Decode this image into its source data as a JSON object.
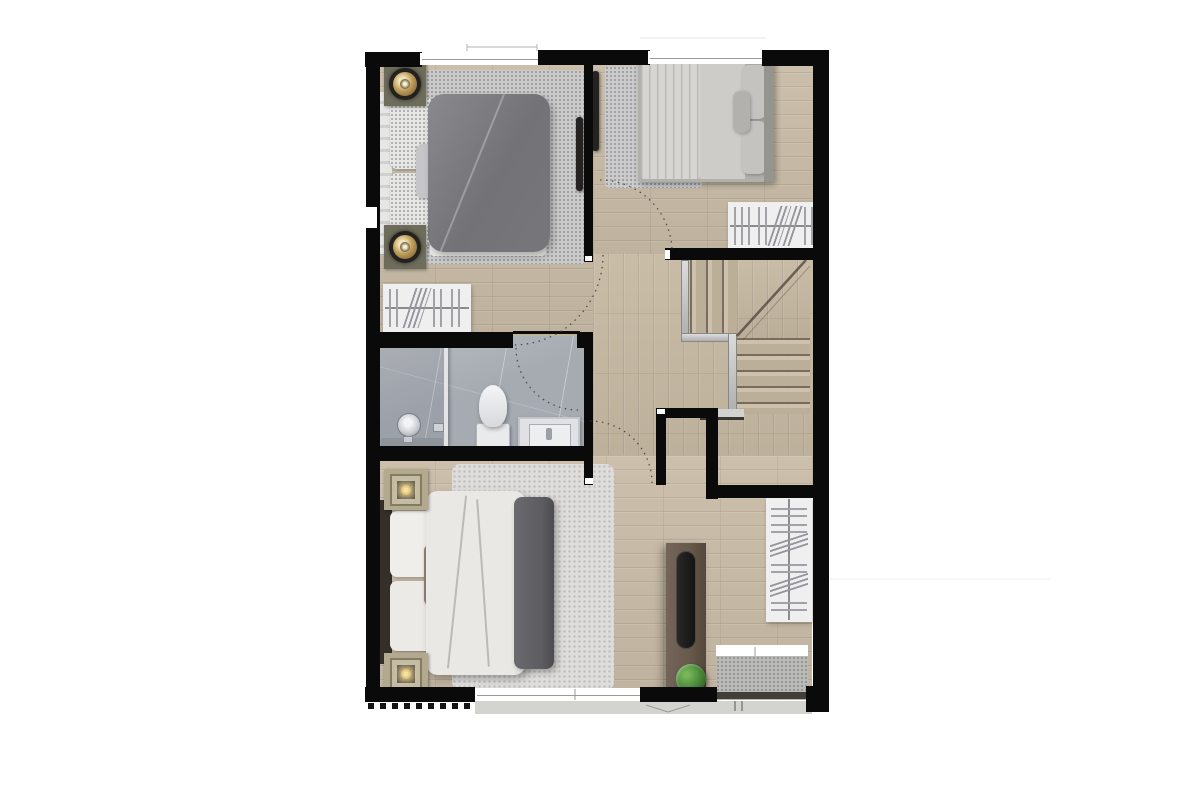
{
  "scene": {
    "type": "architectural-floor-plan-top-view",
    "background": "#ffffff",
    "visible_text": "none"
  },
  "palette": {
    "wall": "#0a0a0a",
    "wood": "#c9bca7",
    "wood_hall": "#c6b9a3",
    "marble": "#a6abb2",
    "rug_speckle": "#cbcbcb",
    "rug_fluffy": "#dedddb",
    "bed1_duvet": "#737377",
    "bed1_pillow": "#e6e6e4",
    "bed2_mattress": "#b1b0ac",
    "bed2_blanket": "#d6d5d1",
    "master_duvet": "#e9e8e4",
    "master_blanket": "#5d5d61",
    "headboard_dark": "#343029",
    "nightstand_dark": "#6e6d5c",
    "nightstand_beige": "#b3a98f",
    "lamp_gold": "#c2a05c",
    "lamp_glow": "#d9b96e",
    "console_wood": "#67594b",
    "tv_black": "#242322",
    "plant_green": "#4e8f3c",
    "wardrobe_bg": "#efefef",
    "wardrobe_line": "#a2a2a8",
    "railing": "#aeaeae",
    "concrete": "#b9bab6",
    "concrete_dark": "#403f3c",
    "window_line": "#9a9a9a",
    "door_arc": "#3c3c3c"
  },
  "rooms": {
    "bedroom1": {
      "name": "bedroom-1",
      "furniture": [
        "double-bed",
        "round-gold-lamp-nightstand-x2",
        "wall-tv",
        "wardrobe",
        "area-rug"
      ]
    },
    "bedroom2": {
      "name": "bedroom-2",
      "furniture": [
        "double-bed",
        "wall-tv",
        "wardrobe",
        "area-rug"
      ]
    },
    "bathroom": {
      "name": "bathroom",
      "furniture": [
        "shower",
        "toilet",
        "vanity-sink"
      ]
    },
    "hall": {
      "name": "hallway",
      "furniture": []
    },
    "stairs": {
      "name": "winder-staircase",
      "furniture": [
        "railing"
      ]
    },
    "master": {
      "name": "master-bedroom",
      "furniture": [
        "double-bed",
        "square-lamp-nightstand-x2",
        "tv-console",
        "plant",
        "wardrobe",
        "fluffy-rug",
        "balcony-ledge"
      ]
    }
  }
}
